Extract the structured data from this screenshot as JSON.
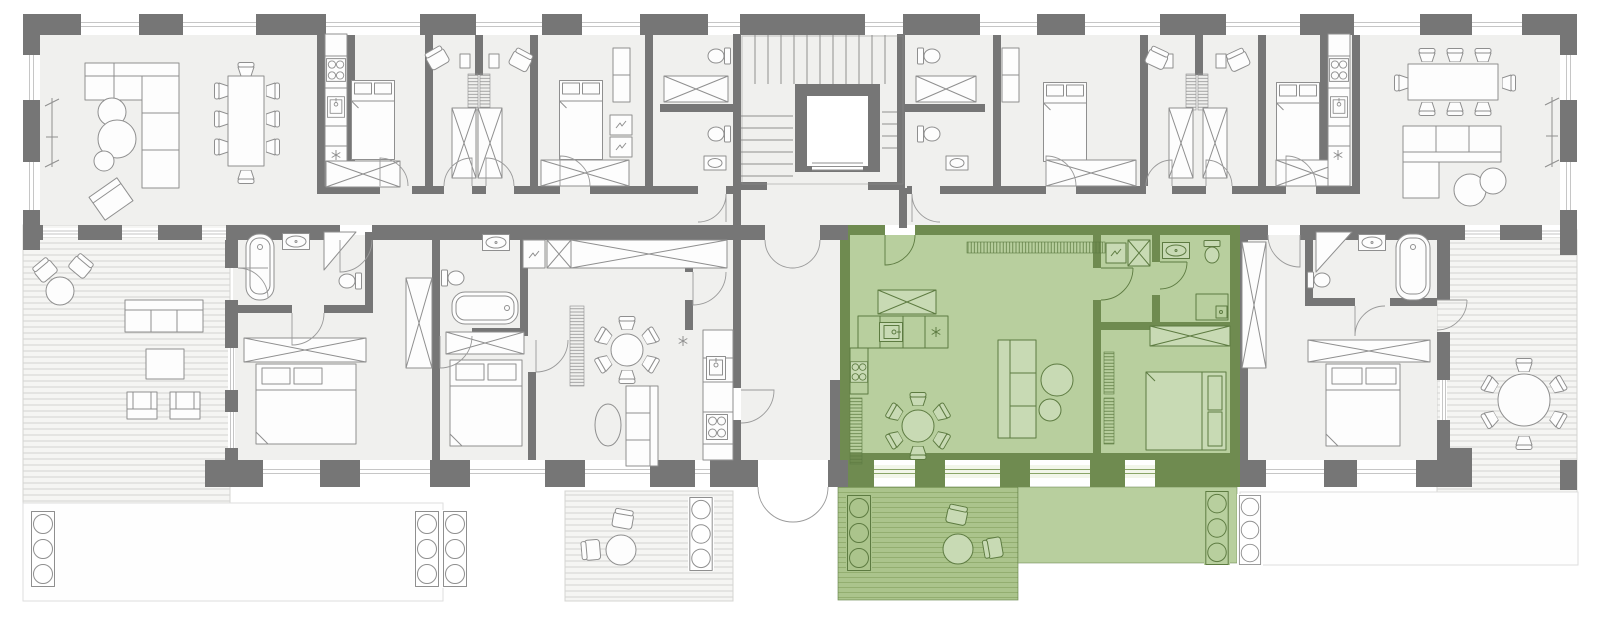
{
  "title": "Residential building floor plan with highlighted apartment",
  "palette": {
    "wall": "#767676",
    "floor": "#f0f0ee",
    "line": "#8f8f8f",
    "furniture_fill": "#fdfdfd",
    "window": "#c6c6c6",
    "deck": "#f5f5f3",
    "deck_line": "#d4d4d2",
    "garden_line": "#dedede",
    "green_wall": "#6f8b50",
    "green_floor": "#b8cf9e",
    "green_fill": "#c8dab4",
    "green_line": "#5d7b41",
    "green_deck": "#abc48c",
    "green_deck_line": "#93ae70"
  },
  "areas": {
    "building": "Apartment building floor plan",
    "living_west": "West living and dining room",
    "living_east": "East living and dining room",
    "core": "Staircase and elevator core",
    "elevator": "Elevator",
    "corridor": "Central corridor",
    "apartment_sw": "South-west apartment",
    "apartment_sm": "South middle apartment",
    "apartment_se": "South-east apartment",
    "highlighted_apartment": "Highlighted apartment (selected unit)",
    "highlighted_terrace": "Highlighted apartment terrace",
    "terrace_west": "West terrace",
    "terrace_middle": "Middle terrace",
    "terrace_east": "East terrace",
    "garden_west": "West garden plot",
    "garden_east": "East garden plot",
    "entrance": "Building entrance"
  }
}
